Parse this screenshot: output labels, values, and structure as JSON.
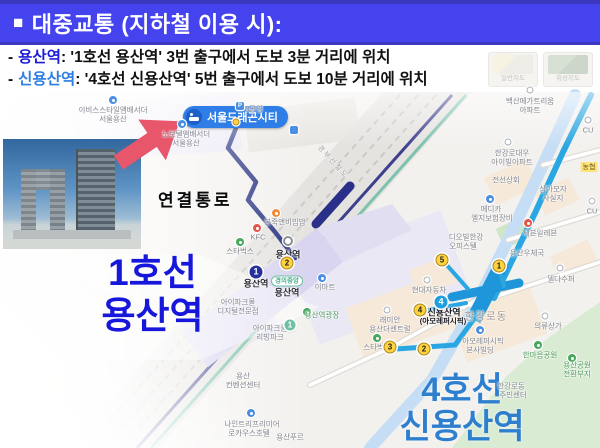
{
  "header": {
    "bullet": "■",
    "title": "대중교통 (지하철 이용 시):"
  },
  "directions": [
    {
      "dash": "-",
      "station": "용산역",
      "rest": ": '1호선 용산역' 3번 출구에서 도보 3분 거리에 위치"
    },
    {
      "dash": "-",
      "station": "신용산역",
      "rest": ": '4호선 신용산역' 5번 출구에서 도보 10분 거리에 위치"
    }
  ],
  "colors": {
    "header_bg": "#4543ee",
    "header_border": "#3b38bf",
    "station1_text": "#1b1bd8",
    "station2_text": "#2d7ee0",
    "big_line1_text": "#1717dc",
    "big_line4_text": "#2e80cf",
    "hotel_pill_bg": "#2f7de6",
    "arrow_red": "#e7566b",
    "line4_route": "#2aa7e2",
    "walk_path_navy": "#25307f",
    "gyeongui_teal": "#7cc2ae",
    "exit_yellow": "#ffd23e"
  },
  "map": {
    "hotel_pill": "서울드래곤시티",
    "big_labels": {
      "line1_a": "1호선",
      "line1_b": "용산역",
      "line4_a": "4호선",
      "line4_b": "신용산역",
      "passage": "연결통로"
    },
    "badges": {
      "line1": "1",
      "line4": "4",
      "jade1": "1",
      "gyeongui": "경의중앙"
    },
    "layer_thumbs": [
      {
        "label": "일반지도"
      },
      {
        "label": "위성지도"
      }
    ],
    "exits": [
      {
        "n": "2",
        "x": 287,
        "y": 263
      },
      {
        "n": "5",
        "x": 442,
        "y": 260
      },
      {
        "n": "1",
        "x": 499,
        "y": 266
      },
      {
        "n": "4",
        "x": 420,
        "y": 310
      },
      {
        "n": "3",
        "x": 390,
        "y": 347
      },
      {
        "n": "2",
        "x": 424,
        "y": 349
      }
    ],
    "pois": [
      {
        "x": 113,
        "y": 100,
        "c": "blue"
      },
      {
        "x": 182,
        "y": 124,
        "c": "blue"
      },
      {
        "x": 240,
        "y": 106,
        "c": "sq",
        "g": "P"
      },
      {
        "x": 294,
        "y": 130,
        "c": "sq"
      },
      {
        "x": 530,
        "y": 90,
        "c": "wc"
      },
      {
        "x": 508,
        "y": 142,
        "c": "wc"
      },
      {
        "x": 588,
        "y": 120,
        "c": "wc"
      },
      {
        "x": 592,
        "y": 201,
        "c": "wc"
      },
      {
        "x": 490,
        "y": 199,
        "c": "blue"
      },
      {
        "x": 528,
        "y": 223,
        "c": "red"
      },
      {
        "x": 560,
        "y": 268,
        "c": "wc"
      },
      {
        "x": 257,
        "y": 228,
        "c": "red"
      },
      {
        "x": 276,
        "y": 213,
        "c": "orange"
      },
      {
        "x": 240,
        "y": 242,
        "c": "green"
      },
      {
        "x": 288,
        "y": 241,
        "c": "korail"
      },
      {
        "x": 322,
        "y": 278,
        "c": "blue"
      },
      {
        "x": 307,
        "y": 312,
        "c": "green"
      },
      {
        "x": 427,
        "y": 280,
        "c": "wc"
      },
      {
        "x": 387,
        "y": 310,
        "c": "wc"
      },
      {
        "x": 377,
        "y": 338,
        "c": "green"
      },
      {
        "x": 480,
        "y": 330,
        "c": "blue"
      },
      {
        "x": 545,
        "y": 316,
        "c": "wc"
      },
      {
        "x": 538,
        "y": 345,
        "c": "green"
      },
      {
        "x": 572,
        "y": 358,
        "c": "green"
      },
      {
        "x": 251,
        "y": 413,
        "c": "blue"
      },
      {
        "x": 236,
        "y": 122,
        "c": "ydot"
      }
    ],
    "labels": [
      {
        "t": "이비스스타일앰배서더",
        "x": 113,
        "y": 110,
        "c": "g"
      },
      {
        "t": "서울용산",
        "x": 113,
        "y": 119,
        "c": "g"
      },
      {
        "t": "노보텔앰배서더",
        "x": 186,
        "y": 134,
        "c": "g"
      },
      {
        "t": "서울용산",
        "x": 186,
        "y": 143,
        "c": "g"
      },
      {
        "t": "3공영",
        "x": 254,
        "y": 109,
        "c": "g"
      },
      {
        "t": "백산메가트리움",
        "x": 530,
        "y": 101,
        "c": "g"
      },
      {
        "t": "아파트",
        "x": 530,
        "y": 110,
        "c": "g"
      },
      {
        "t": "한강로대우",
        "x": 512,
        "y": 153,
        "c": "g"
      },
      {
        "t": "아이빌아파트",
        "x": 512,
        "y": 162,
        "c": "g"
      },
      {
        "t": "전선상회",
        "x": 506,
        "y": 180,
        "c": "g"
      },
      {
        "t": "삼아모자",
        "x": 553,
        "y": 189,
        "c": "g"
      },
      {
        "t": "사실지",
        "x": 553,
        "y": 198,
        "c": "g"
      },
      {
        "t": "CU",
        "x": 588,
        "y": 130,
        "c": "g"
      },
      {
        "t": "농협",
        "x": 589,
        "y": 167,
        "c": "y"
      },
      {
        "t": "CU",
        "x": 592,
        "y": 211,
        "c": "g"
      },
      {
        "t": "메디카",
        "x": 491,
        "y": 209,
        "c": "g"
      },
      {
        "t": "엘지보험장비",
        "x": 492,
        "y": 218,
        "c": "g"
      },
      {
        "t": "디오빌한강",
        "x": 466,
        "y": 237,
        "c": "g"
      },
      {
        "t": "오피스텔",
        "x": 463,
        "y": 246,
        "c": "g"
      },
      {
        "t": "세븐일레븐",
        "x": 540,
        "y": 233,
        "c": "g"
      },
      {
        "t": "용산우체국",
        "x": 527,
        "y": 253,
        "c": "g"
      },
      {
        "t": "델다수퍼",
        "x": 561,
        "y": 279,
        "c": "g"
      },
      {
        "t": "본죽앤비빔밥",
        "x": 285,
        "y": 222,
        "c": "g"
      },
      {
        "t": "KFC",
        "x": 258,
        "y": 237,
        "c": "g"
      },
      {
        "t": "스타벅스",
        "x": 240,
        "y": 251,
        "c": "g"
      },
      {
        "t": "용산역",
        "x": 288,
        "y": 254,
        "c": "d"
      },
      {
        "t": "용산역",
        "x": 256,
        "y": 283,
        "c": "d"
      },
      {
        "t": "용산역",
        "x": 287,
        "y": 292,
        "c": "d"
      },
      {
        "t": "이마트",
        "x": 325,
        "y": 287,
        "c": "g"
      },
      {
        "t": "아이파크몰",
        "x": 238,
        "y": 302,
        "c": "g"
      },
      {
        "t": "디지털전문점",
        "x": 238,
        "y": 311,
        "c": "g"
      },
      {
        "t": "아이파크몰",
        "x": 270,
        "y": 328,
        "c": "g"
      },
      {
        "t": "리빙파크",
        "x": 270,
        "y": 337,
        "c": "g"
      },
      {
        "t": "용산역광장",
        "x": 322,
        "y": 315,
        "c": "gr"
      },
      {
        "t": "용산",
        "x": 243,
        "y": 376,
        "c": "g"
      },
      {
        "t": "컨벤션센터",
        "x": 243,
        "y": 385,
        "c": "g"
      },
      {
        "t": "나인트리프리미어",
        "x": 252,
        "y": 424,
        "c": "g"
      },
      {
        "t": "로카우스호텔",
        "x": 249,
        "y": 433,
        "c": "g"
      },
      {
        "t": "용산푸르",
        "x": 290,
        "y": 437,
        "c": "g"
      },
      {
        "t": "현대자동차",
        "x": 429,
        "y": 290,
        "c": "g"
      },
      {
        "t": "래미안",
        "x": 390,
        "y": 320,
        "c": "g"
      },
      {
        "t": "용산더센트럴",
        "x": 390,
        "y": 329,
        "c": "g"
      },
      {
        "t": "스타벅스",
        "x": 377,
        "y": 347,
        "c": "g"
      },
      {
        "t": "신용산역",
        "x": 444,
        "y": 312,
        "c": "st"
      },
      {
        "t": "(아모레퍼시픽)",
        "x": 443,
        "y": 321,
        "c": "st2"
      },
      {
        "t": "한강로동",
        "x": 486,
        "y": 316,
        "c": "a"
      },
      {
        "t": "아모레퍼시픽",
        "x": 483,
        "y": 341,
        "c": "g"
      },
      {
        "t": "본사빌딩",
        "x": 480,
        "y": 350,
        "c": "g"
      },
      {
        "t": "의류상가",
        "x": 548,
        "y": 326,
        "c": "g"
      },
      {
        "t": "한마음공원",
        "x": 540,
        "y": 355,
        "c": "gr"
      },
      {
        "t": "용산공원",
        "x": 577,
        "y": 365,
        "c": "gr"
      },
      {
        "t": "전환부지",
        "x": 577,
        "y": 374,
        "c": "gr"
      },
      {
        "t": "한강로동",
        "x": 511,
        "y": 386,
        "c": "g"
      },
      {
        "t": "주민센터",
        "x": 513,
        "y": 395,
        "c": "g"
      },
      {
        "t": "경부선철도",
        "x": 333,
        "y": 162,
        "c": "rr"
      }
    ]
  }
}
